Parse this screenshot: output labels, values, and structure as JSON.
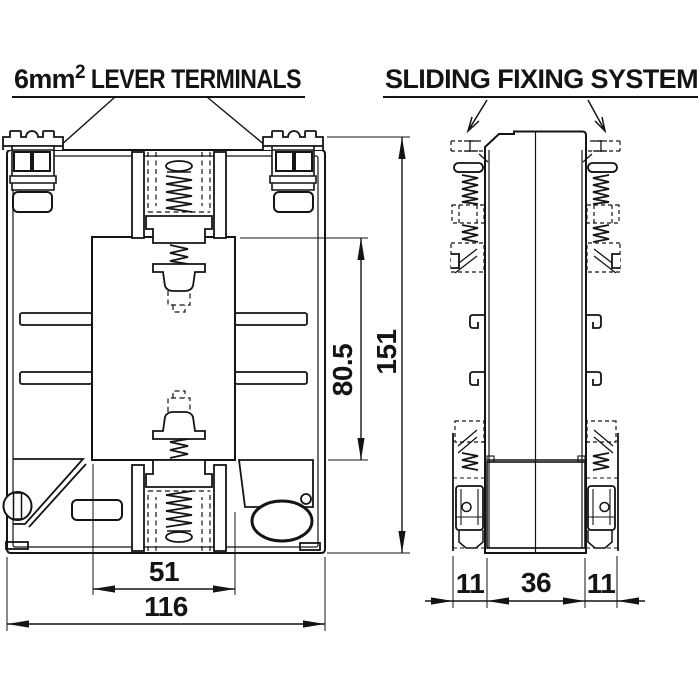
{
  "titles": {
    "lever_base": "6mm",
    "lever_sup": "2",
    "lever_rest": " LEVER TERMINALS",
    "sliding": "SLIDING FIXING SYSTEM"
  },
  "dimensions": {
    "overall_height": "151",
    "window_height": "80.5",
    "window_width": "51",
    "overall_width": "116",
    "side_flange_left": "11",
    "side_body": "36",
    "side_flange_right": "11"
  },
  "colors": {
    "background": "#ffffff",
    "line": "#141414"
  }
}
